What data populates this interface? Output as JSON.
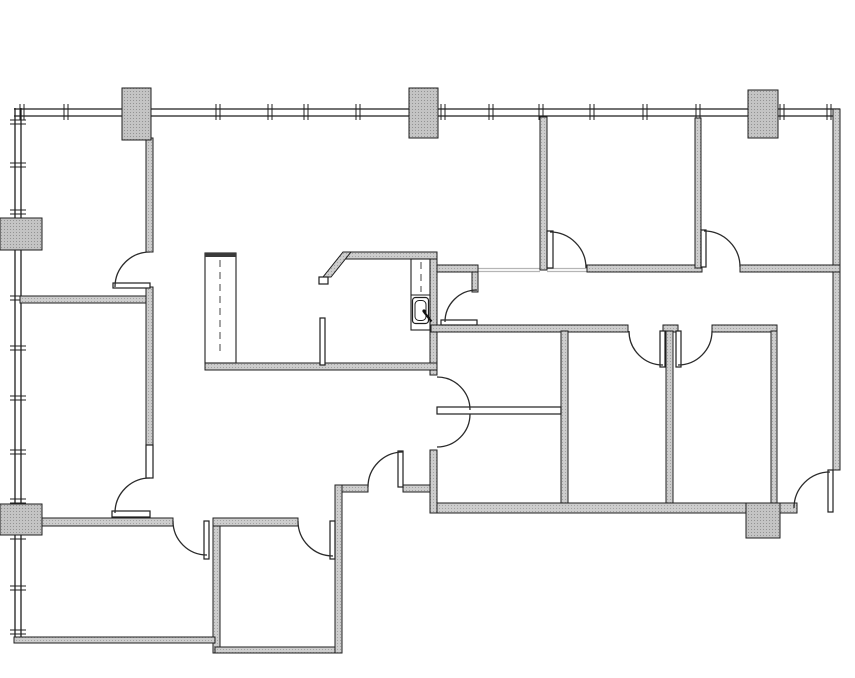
{
  "plan": {
    "canvas": {
      "width": 855,
      "height": 678,
      "background": "#ffffff"
    },
    "colors": {
      "line": "#1f1f1f",
      "arc": "#2b2b2b",
      "wall_fill": "#cdcdcd",
      "wall_dot": "#a3a3a3",
      "column_fill": "#c4c4c4",
      "column_dot": "#939393",
      "thin_fill": "#ffffff",
      "light_line": "#b5b5b5",
      "cabinet_cap": "#3a3a3a",
      "dash": "#444444",
      "fixture": "#111111"
    },
    "curtain_walls": {
      "top": {
        "x1": 14,
        "x2": 840,
        "y": 108,
        "ticks": [
          22,
          66,
          218,
          270,
          306,
          358,
          443,
          491,
          541,
          592,
          645,
          698,
          782,
          829
        ]
      },
      "left": {
        "y1": 108,
        "y2": 638,
        "x": 14,
        "ticks": [
          122,
          165,
          212,
          298,
          348,
          398,
          452,
          501,
          537,
          588,
          632
        ]
      }
    },
    "walls_thick": [
      {
        "name": "right-exterior-wall",
        "r": [
          833,
          109,
          7,
          361
        ]
      },
      {
        "name": "bottom-exterior-wall",
        "r": [
          431,
          503,
          366,
          10
        ]
      },
      {
        "name": "topleft-room-right-wall",
        "r": [
          146,
          138,
          7,
          114
        ]
      },
      {
        "name": "left-rooms-divider-wall",
        "r": [
          20,
          296,
          127,
          7
        ]
      },
      {
        "name": "leftmid-room-right-wall",
        "r": [
          146,
          287,
          7,
          158
        ]
      },
      {
        "name": "bottomleft-room-top-wall",
        "r": [
          40,
          518,
          133,
          8
        ]
      },
      {
        "name": "bottommid-room-top-wall",
        "r": [
          213,
          518,
          85,
          8
        ]
      },
      {
        "name": "bottomleft-room-right-wall",
        "r": [
          213,
          526,
          7,
          127
        ]
      },
      {
        "name": "bottomleft-exterior-wall",
        "r": [
          14,
          637,
          201,
          6
        ]
      },
      {
        "name": "bottommid-room-bottom-wall",
        "r": [
          215,
          647,
          125,
          6
        ]
      },
      {
        "name": "bottommid-room-right-wall",
        "r": [
          335,
          485,
          7,
          168
        ]
      },
      {
        "name": "vestibule-wall-west",
        "r": [
          342,
          485,
          26,
          7
        ]
      },
      {
        "name": "vestibule-wall-east",
        "r": [
          403,
          485,
          30,
          7
        ]
      },
      {
        "name": "center-wall-mid",
        "r": [
          430,
          252,
          7,
          123
        ]
      },
      {
        "name": "center-wall-lower",
        "r": [
          430,
          450,
          7,
          63
        ]
      },
      {
        "name": "kitchen-top-wall",
        "r": [
          345,
          252,
          92,
          7
        ]
      },
      {
        "name": "kitchen-bottom-wall",
        "r": [
          205,
          363,
          232,
          7
        ]
      },
      {
        "name": "closet-top-wall",
        "r": [
          437,
          265,
          41,
          7
        ]
      },
      {
        "name": "closet-side-wall",
        "r": [
          472,
          272,
          6,
          20
        ]
      },
      {
        "name": "corridor-wall-west",
        "r": [
          431,
          325,
          197,
          7
        ]
      },
      {
        "name": "corridor-wall-post",
        "r": [
          663,
          325,
          15,
          7
        ]
      },
      {
        "name": "corridor-wall-east",
        "r": [
          712,
          325,
          65,
          7
        ]
      },
      {
        "name": "topright-rooms-bottom-wall-west",
        "r": [
          587,
          265,
          115,
          7
        ]
      },
      {
        "name": "topright-rooms-bottom-wall-east",
        "r": [
          740,
          265,
          100,
          7
        ]
      },
      {
        "name": "topright-rooms-divider-wall",
        "r": [
          695,
          118,
          6,
          150
        ]
      },
      {
        "name": "reception-partition-wall",
        "r": [
          540,
          117,
          7,
          153
        ]
      },
      {
        "name": "bottomright-room1-left-wall",
        "r": [
          561,
          331,
          7,
          172
        ]
      },
      {
        "name": "bottomright-rooms-divider-wall",
        "r": [
          666,
          331,
          7,
          172
        ]
      },
      {
        "name": "bottomright-rooms-right-wall",
        "r": [
          771,
          331,
          6,
          172
        ]
      }
    ],
    "angled_wall": {
      "name": "kitchen-angled-wall",
      "points": "343,252 351,252 331,277 323,277"
    },
    "columns": [
      {
        "name": "column-top-left",
        "r": [
          122,
          88,
          29,
          52
        ]
      },
      {
        "name": "column-top-center",
        "r": [
          409,
          88,
          29,
          50
        ]
      },
      {
        "name": "column-top-right",
        "r": [
          748,
          90,
          30,
          48
        ]
      },
      {
        "name": "column-left-upper",
        "r": [
          0,
          218,
          42,
          32
        ]
      },
      {
        "name": "column-left-lower",
        "r": [
          0,
          504,
          42,
          31
        ]
      },
      {
        "name": "column-bottom-right",
        "r": [
          746,
          503,
          34,
          35
        ]
      }
    ],
    "walls_thin": [
      {
        "name": "sidelite-leftmid-room",
        "r": [
          146,
          445,
          7,
          33
        ]
      },
      {
        "name": "door-leaf-topleft-room",
        "r": [
          113,
          283,
          37,
          5
        ]
      },
      {
        "name": "door-leaf-leftmid-room",
        "r": [
          112,
          511,
          38,
          6
        ]
      },
      {
        "name": "door-leaf-bottomleft-room",
        "r": [
          204,
          521,
          5,
          38
        ]
      },
      {
        "name": "door-leaf-bottommid-room",
        "r": [
          330,
          521,
          5,
          38
        ]
      },
      {
        "name": "door-leaf-vestibule",
        "r": [
          398,
          451,
          5,
          36
        ]
      },
      {
        "name": "door-leaf-closet",
        "r": [
          441,
          320,
          36,
          5
        ]
      },
      {
        "name": "door-leaf-topright-room1",
        "r": [
          547,
          231,
          6,
          37
        ]
      },
      {
        "name": "door-leaf-topright-room2",
        "r": [
          701,
          230,
          5,
          37
        ]
      },
      {
        "name": "door-leaf-bottomright-room1",
        "r": [
          660,
          331,
          5,
          36
        ]
      },
      {
        "name": "door-leaf-bottomright-room2",
        "r": [
          676,
          331,
          5,
          36
        ]
      },
      {
        "name": "door-leaf-exterior",
        "r": [
          828,
          470,
          5,
          42
        ]
      },
      {
        "name": "glass-partition-double-door",
        "r": [
          437,
          407,
          124,
          7
        ]
      },
      {
        "name": "kitchen-stub-wall",
        "r": [
          320,
          318,
          5,
          47
        ]
      },
      {
        "name": "kitchen-angled-wall-cap",
        "r": [
          319,
          277,
          9,
          7
        ]
      }
    ],
    "door_arcs": [
      {
        "name": "door-arc-topleft-room",
        "a": [
          150,
          287,
          35,
          180,
          270
        ]
      },
      {
        "name": "door-arc-leftmid-room",
        "a": [
          150,
          513,
          35,
          180,
          270
        ]
      },
      {
        "name": "door-arc-bottomleft-room",
        "a": [
          207,
          521,
          34,
          90,
          180
        ]
      },
      {
        "name": "door-arc-bottommid-room",
        "a": [
          333,
          521,
          35,
          90,
          180
        ]
      },
      {
        "name": "door-arc-vestibule",
        "a": [
          403,
          487,
          35,
          180,
          270
        ]
      },
      {
        "name": "door-arc-double-north",
        "a": [
          437,
          410,
          33,
          270,
          360
        ]
      },
      {
        "name": "door-arc-double-south",
        "a": [
          437,
          414,
          33,
          0,
          90
        ]
      },
      {
        "name": "door-arc-closet",
        "a": [
          477,
          322,
          32,
          180,
          270
        ]
      },
      {
        "name": "door-arc-topright-room1",
        "a": [
          550,
          268,
          36,
          270,
          360
        ]
      },
      {
        "name": "door-arc-topright-room2",
        "a": [
          704,
          267,
          36,
          270,
          360
        ]
      },
      {
        "name": "door-arc-bottomright-room1",
        "a": [
          663,
          331,
          34,
          90,
          180
        ]
      },
      {
        "name": "door-arc-bottomright-room2",
        "a": [
          678,
          331,
          34,
          0,
          90
        ]
      },
      {
        "name": "door-arc-exterior",
        "a": [
          830,
          508,
          36,
          180,
          270
        ]
      }
    ],
    "light_lines": [
      [
        478,
        268.5,
        540,
        268.5
      ],
      [
        547,
        268.5,
        587,
        268.5
      ],
      [
        478,
        271.5,
        540,
        271.5
      ],
      [
        547,
        271.5,
        587,
        271.5
      ]
    ],
    "kitchen": {
      "cabinet": {
        "x": 205,
        "y": 253,
        "w": 31,
        "h": 110,
        "cap_h": 4
      },
      "counter": {
        "x": 411,
        "y": 259,
        "w": 19,
        "h": 71,
        "divider_y": 295
      },
      "sink": {
        "x": 412.5,
        "y": 297.5,
        "w": 16,
        "h": 26,
        "dot_x": 424,
        "dot_y": 311,
        "handle": [
          424,
          312,
          431.5,
          321.5
        ]
      },
      "dashed_lines": [
        [
          220,
          260,
          220,
          356
        ],
        [
          421,
          262,
          421,
          292
        ]
      ]
    }
  }
}
